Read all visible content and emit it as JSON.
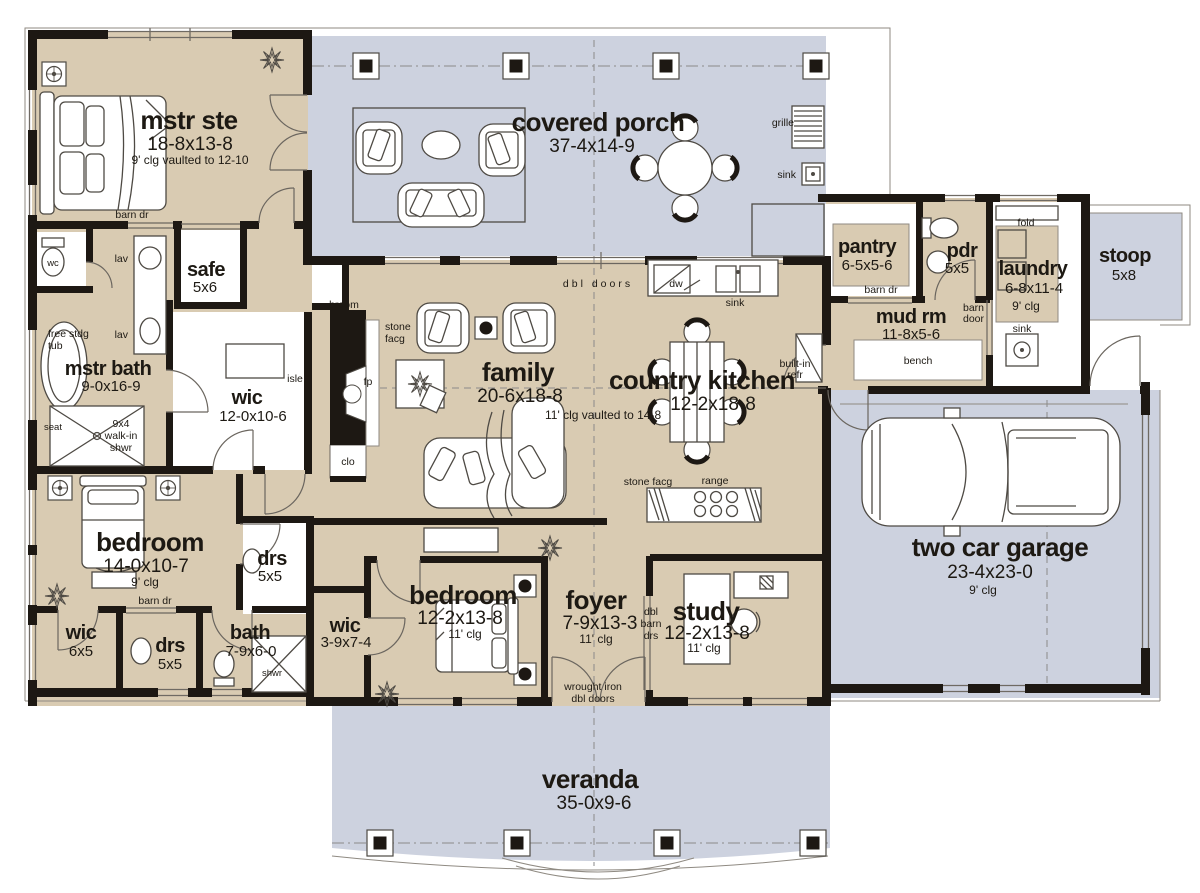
{
  "palette": {
    "interior_beige": "#d9cbb2",
    "porch_gray": "#cdd2df",
    "wall_black": "#1d1813",
    "fixture_white": "#ffffff",
    "line_gray": "#8f8a82"
  },
  "rooms": {
    "mstr_ste": {
      "name": "mstr ste",
      "dims": "18-8x13-8",
      "note": "9' clg vaulted to 12-10"
    },
    "covered_porch": {
      "name": "covered porch",
      "dims": "37-4x14-9"
    },
    "pantry": {
      "name": "pantry",
      "dims": "6-5x5-6"
    },
    "pdr": {
      "name": "pdr",
      "dims": "5x5"
    },
    "laundry": {
      "name": "laundry",
      "dims": "6-8x11-4",
      "note": "9' clg"
    },
    "stoop": {
      "name": "stoop",
      "dims": "5x8"
    },
    "mud_rm": {
      "name": "mud rm",
      "dims": "11-8x5-6"
    },
    "mstr_bath": {
      "name": "mstr bath",
      "dims": "9-0x16-9"
    },
    "wic_master": {
      "name": "wic",
      "dims": "12-0x10-6"
    },
    "safe": {
      "name": "safe",
      "dims": "5x6"
    },
    "family": {
      "name": "family",
      "dims": "20-6x18-8",
      "note": "11' clg vaulted to 14-8"
    },
    "country_kitchen": {
      "name": "country kitchen",
      "dims": "12-2x18-8"
    },
    "garage": {
      "name": "two car garage",
      "dims": "23-4x23-0",
      "note": "9' clg"
    },
    "bedroom_14": {
      "name": "bedroom",
      "dims": "14-0x10-7",
      "note": "9' clg"
    },
    "drs_upper": {
      "name": "drs",
      "dims": "5x5"
    },
    "wic_6x5": {
      "name": "wic",
      "dims": "6x5"
    },
    "drs_lower": {
      "name": "drs",
      "dims": "5x5"
    },
    "bath": {
      "name": "bath",
      "dims": "7-9x6-0"
    },
    "wic_3_9": {
      "name": "wic",
      "dims": "3-9x7-4"
    },
    "bedroom_12": {
      "name": "bedroom",
      "dims": "12-2x13-8",
      "note": "11' clg"
    },
    "foyer": {
      "name": "foyer",
      "dims": "7-9x13-3",
      "note": "11' clg"
    },
    "study": {
      "name": "study",
      "dims": "12-2x13-8",
      "note": "11' clg"
    },
    "veranda": {
      "name": "veranda",
      "dims": "35-0x9-6"
    }
  },
  "labels": {
    "barn_dr": "barn dr",
    "barn_door_lines": [
      "barn",
      "door"
    ],
    "dbl_barn_drs_lines": [
      "dbl",
      "barn",
      "drs"
    ],
    "dbl_doors": "dbl doors",
    "wrought_iron_lines": [
      "wrought iron",
      "dbl doors"
    ],
    "free_stdg_tub_lines": [
      "free stdg",
      "tub"
    ],
    "walk_in_shwr_lines": [
      "9x4",
      "walk-in",
      "shwr"
    ],
    "stone_facg_lines": [
      "stone",
      "facg"
    ],
    "stone_facg": "stone facg",
    "built_in_refr_lines": [
      "built-in",
      "refr"
    ],
    "grille": "grille",
    "sink": "sink",
    "dw": "dw",
    "fold": "fold",
    "bench": "bench",
    "wc": "wc",
    "lav": "lav",
    "isle": "isle",
    "broom": "broom",
    "fp": "fp",
    "clo": "clo",
    "seat": "seat",
    "shwr": "shwr",
    "range": "range"
  }
}
